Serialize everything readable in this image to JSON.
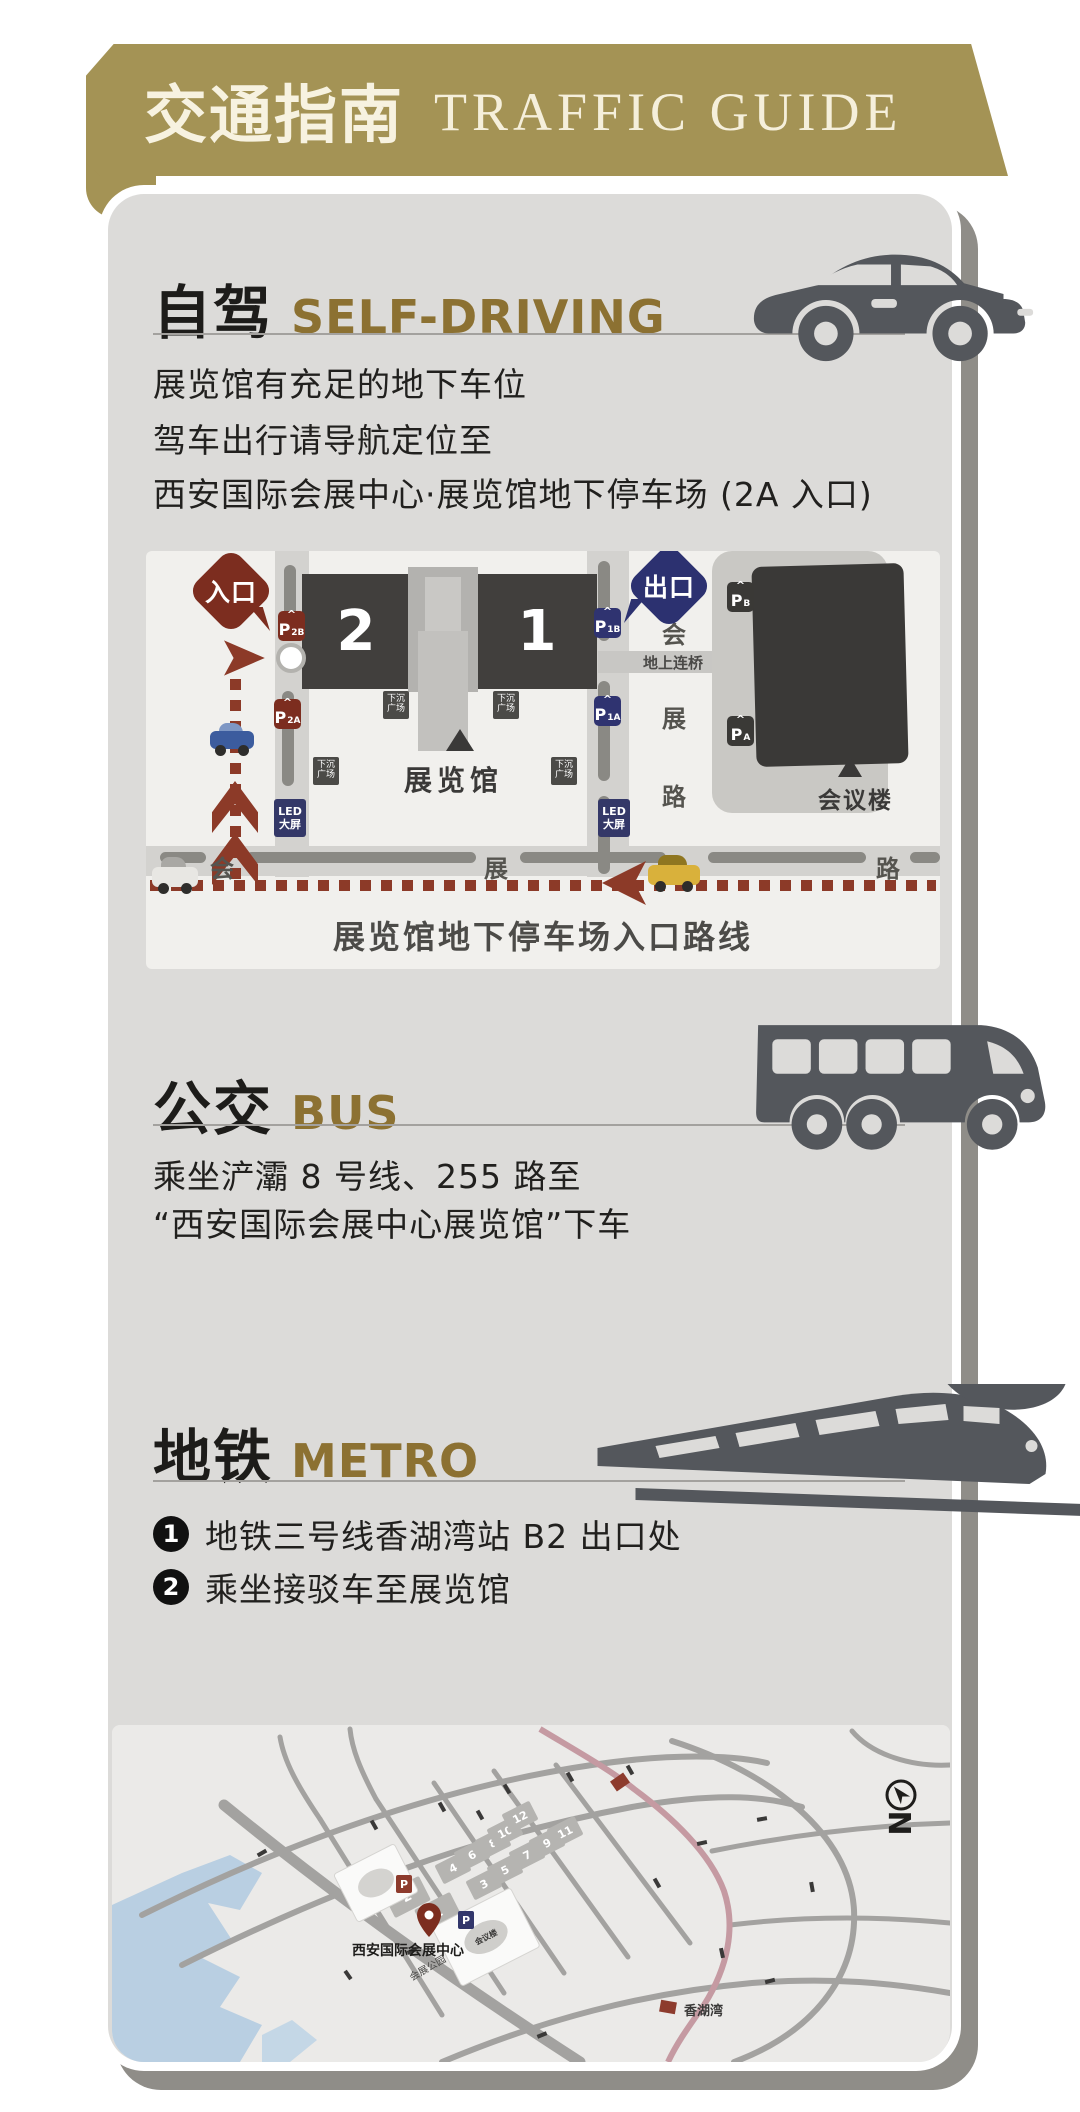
{
  "banner": {
    "title_zh": "交通指南",
    "title_en": "TRAFFIC GUIDE"
  },
  "self_driving": {
    "title_zh": "自驾",
    "title_en": "SELF-DRIVING",
    "lines": [
      "展览馆有充足的地下车位",
      "驾车出行请导航定位至",
      "西安国际会展中心·展览馆地下停车场 (2A 入口)"
    ]
  },
  "parking_map": {
    "entrance": "入口",
    "exit": "出口",
    "hall_left": "2",
    "hall_right": "1",
    "exhibition_hall": "展览馆",
    "conference_hall": "会议楼",
    "bridge": "地上连桥",
    "sunken_plaza": "下沉\n广场",
    "led_screen": "LED\n大屏",
    "road_vertical": [
      "会",
      "展",
      "路"
    ],
    "road_bottom": [
      "会",
      "展",
      "一",
      "路"
    ],
    "badges": {
      "p2b": {
        "p": "P",
        "sub": "2B"
      },
      "p2a": {
        "p": "P",
        "sub": "2A"
      },
      "p1b": {
        "p": "P",
        "sub": "1B"
      },
      "p1a": {
        "p": "P",
        "sub": "1A"
      },
      "pb": {
        "p": "P",
        "sub": "B"
      },
      "pa": {
        "p": "P",
        "sub": "A"
      }
    },
    "caption": "展览馆地下停车场入口路线"
  },
  "bus": {
    "title_zh": "公交",
    "title_en": "BUS",
    "lines": [
      "乘坐浐灞 8 号线、255 路至",
      "“西安国际会展中心展览馆”下车"
    ]
  },
  "metro": {
    "title_zh": "地铁",
    "title_en": "METRO",
    "steps": [
      {
        "num": "1",
        "text": "地铁三号线香湖湾站 B2 出口处"
      },
      {
        "num": "2",
        "text": "乘坐接驳车至展览馆"
      }
    ]
  },
  "city_map": {
    "halls": [
      "1",
      "2",
      "3",
      "4",
      "5",
      "6",
      "7",
      "8",
      "9",
      "10",
      "11",
      "12"
    ],
    "pin_label": "西安国际会展中心",
    "station_label": "香湖湾",
    "road_label": "会展公园",
    "conference_label": "会议楼",
    "parking_red": "P",
    "parking_blue": "P",
    "compass": "N"
  },
  "colors": {
    "banner_gold": "#a49355",
    "accent_gold": "#8c7132",
    "route_red": "#8c3a28",
    "navy": "#34386e",
    "metro_pink": "#c59aa2"
  }
}
